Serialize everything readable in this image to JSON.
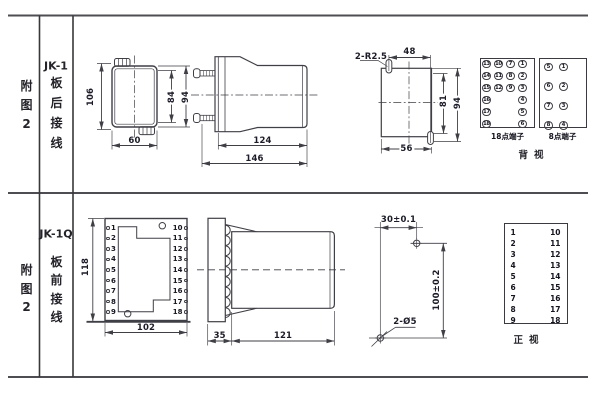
{
  "colors": {
    "ink": "#3f3f46",
    "text": "#1c1c28",
    "background": "#ffffff"
  },
  "table": {
    "rows": [
      {
        "fig": "附图2",
        "model": "JK-1",
        "wiring": "板后接线"
      },
      {
        "fig": "附图2",
        "model": "JK-1Q",
        "wiring": "板前接线"
      }
    ]
  },
  "rear_view": {
    "dim_height": "106",
    "dim_width": "60",
    "dim_inner_height": "84",
    "dim_outer_height": "94"
  },
  "rear_side_view": {
    "dim_body_depth": "124",
    "dim_total_depth": "146"
  },
  "panel_cutout": {
    "slot_label": "2-R2.5",
    "dim_slot_span": "48",
    "dim_inner": "81",
    "dim_outer": "94",
    "dim_width": "56"
  },
  "back_view": {
    "caption": "背视",
    "t18": {
      "label": "18点端子",
      "columns": [
        [
          "13",
          "14",
          "15",
          "16",
          "17",
          "18"
        ],
        [
          "10",
          "11",
          "12"
        ],
        [
          "7",
          "8",
          "9"
        ],
        [
          "1",
          "2",
          "3",
          "4",
          "5",
          "6"
        ]
      ]
    },
    "t8": {
      "label": "8点端子",
      "columns": [
        [
          "5",
          "6",
          "7",
          "8"
        ],
        [
          "1",
          "2",
          "3",
          "4"
        ]
      ]
    }
  },
  "front_view": {
    "dim_height": "118",
    "dim_width": "102",
    "left_terminals": [
      "1",
      "2",
      "3",
      "4",
      "5",
      "6",
      "7",
      "8",
      "9"
    ],
    "right_terminals": [
      "10",
      "11",
      "12",
      "13",
      "14",
      "15",
      "16",
      "17",
      "18"
    ]
  },
  "front_side_view": {
    "dim_plate": "35",
    "dim_body": "121"
  },
  "drill_plan": {
    "dim_horizontal": "30±0.1",
    "dim_vertical": "100±0.2",
    "holes_label": "2-Ø5"
  },
  "front_terminal_table": {
    "caption": "正视",
    "left": [
      "1",
      "2",
      "3",
      "4",
      "5",
      "6",
      "7",
      "8",
      "9"
    ],
    "right": [
      "10",
      "11",
      "12",
      "13",
      "14",
      "15",
      "16",
      "17",
      "18"
    ]
  }
}
